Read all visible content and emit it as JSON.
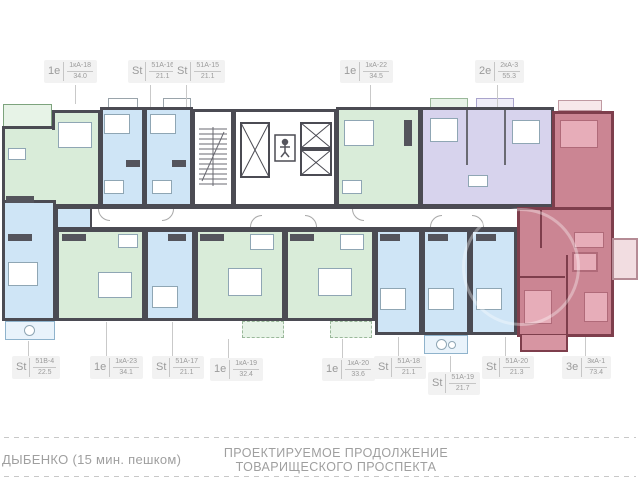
{
  "colors": {
    "wall": "#4b4b53",
    "green": "#d9ecd9",
    "green_light": "#e7f3e7",
    "blue": "#cfe5f6",
    "blue_light": "#e9f3fb",
    "purple": "#d7d3ed",
    "red": "#cb8593",
    "red_wall": "#7e3e4c",
    "red_furn": "#e7adb9",
    "label_text": "#9b9b9b",
    "label_bg": "#f2f2f2",
    "leader": "#c9c9c9",
    "footer_text": "#9f9f9f",
    "dash": "#c8c8c8"
  },
  "units_top": [
    {
      "type": "1е",
      "code": "1кА-18",
      "area": "34.0"
    },
    {
      "type": "St",
      "code": "51А-16",
      "area": "21.1"
    },
    {
      "type": "St",
      "code": "51А-15",
      "area": "21.1"
    },
    {
      "type": "1е",
      "code": "1кА-22",
      "area": "34.5"
    },
    {
      "type": "2е",
      "code": "2кА-3",
      "area": "55.3"
    }
  ],
  "units_bottom": [
    {
      "type": "St",
      "code": "51В-4",
      "area": "22.5"
    },
    {
      "type": "1е",
      "code": "1кА-23",
      "area": "34.1"
    },
    {
      "type": "St",
      "code": "51А-17",
      "area": "21.1"
    },
    {
      "type": "1е",
      "code": "1кА-19",
      "area": "32.4"
    },
    {
      "type": "1е",
      "code": "1кА-20",
      "area": "33.6"
    },
    {
      "type": "St",
      "code": "51А-18",
      "area": "21.1"
    },
    {
      "type": "St",
      "code": "51А-19",
      "area": "21.7"
    },
    {
      "type": "St",
      "code": "51А-20",
      "area": "21.3"
    },
    {
      "type": "3е",
      "code": "3кА-1",
      "area": "73.4"
    }
  ],
  "footer": {
    "metro": "ДЫБЕНКО (15 мин.  пешком)",
    "street": "ПРОЕКТИРУЕМОЕ ПРОДОЛЖЕНИЕ ТОВАРИЩЕСКОГО ПРОСПЕКТА"
  }
}
